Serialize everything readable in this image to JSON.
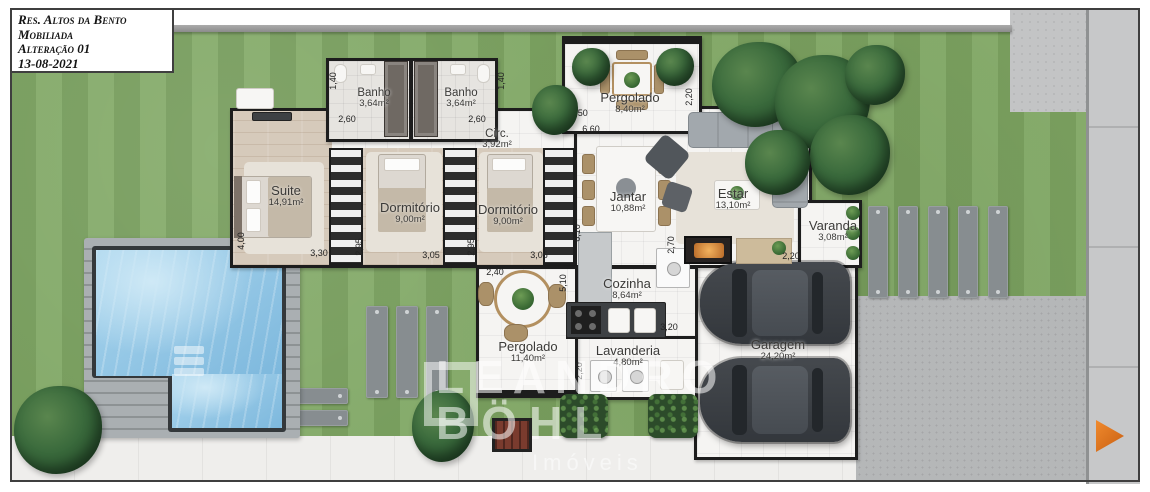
{
  "title_block": {
    "lines": [
      "Res. Altos da Bento",
      "Mobiliada",
      "Alteração 01",
      "13-08-2021"
    ]
  },
  "watermark": {
    "line1": "LEANDRO",
    "line2": "BÖHL",
    "line3": "Imóveis"
  },
  "rooms": {
    "banho1": {
      "name": "Banho",
      "area": "3,64m²"
    },
    "banho2": {
      "name": "Banho",
      "area": "3,64m²"
    },
    "pergolado_top": {
      "name": "Pergolado",
      "area": "8,40m²"
    },
    "circ": {
      "name": "Circ.",
      "area": "3,92m²"
    },
    "suite": {
      "name": "Suite",
      "area": "14,91m²"
    },
    "dorm1": {
      "name": "Dormitório",
      "area": "9,00m²"
    },
    "dorm2": {
      "name": "Dormitório",
      "area": "9,00m²"
    },
    "jantar": {
      "name": "Jantar",
      "area": "10,88m²"
    },
    "estar": {
      "name": "Estar",
      "area": "13,10m²"
    },
    "varanda": {
      "name": "Varanda",
      "area": "3,08m²"
    },
    "cozinha": {
      "name": "Cozinha",
      "area": "8,64m²"
    },
    "pergolado_bottom": {
      "name": "Pergolado",
      "area": "11,40m²"
    },
    "lavanderia": {
      "name": "Lavanderia",
      "area": "4,80m²"
    },
    "garagem": {
      "name": "Garagem",
      "area": "24,20m²"
    }
  },
  "dimensions": {
    "banho1_depth": "1,40",
    "banho1_width": "2,60",
    "banho2_depth": "1,40",
    "banho2_width": "2,60",
    "pergolado_top_door": "3,50",
    "pergolado_top_width": "6,60",
    "pergolado_top_depth": "2,20",
    "suite_depth": "4,00",
    "suite_width": "3,30",
    "dorm1_depth": "2,95",
    "dorm1_width": "3,05",
    "dorm2_depth": "2,95",
    "dorm2_width": "3,05",
    "pergolado_b_width": "2,40",
    "pergolado_b_depth": "5,10",
    "social_depth": "6,10",
    "estar_kitchen_wall": "2,70",
    "estar_depth": "4,10",
    "varanda_width": "2,20",
    "cozinha_width": "3,20",
    "lavanderia_depth": "2,20"
  },
  "colors": {
    "wall": "#1d1d1d",
    "grass": "#7fa763",
    "pool_water": "#8fc2e2",
    "street": "#c7c8c9",
    "car": "#3f4347",
    "tree": "#2f5a35",
    "accent_orange": "#e0731f"
  }
}
